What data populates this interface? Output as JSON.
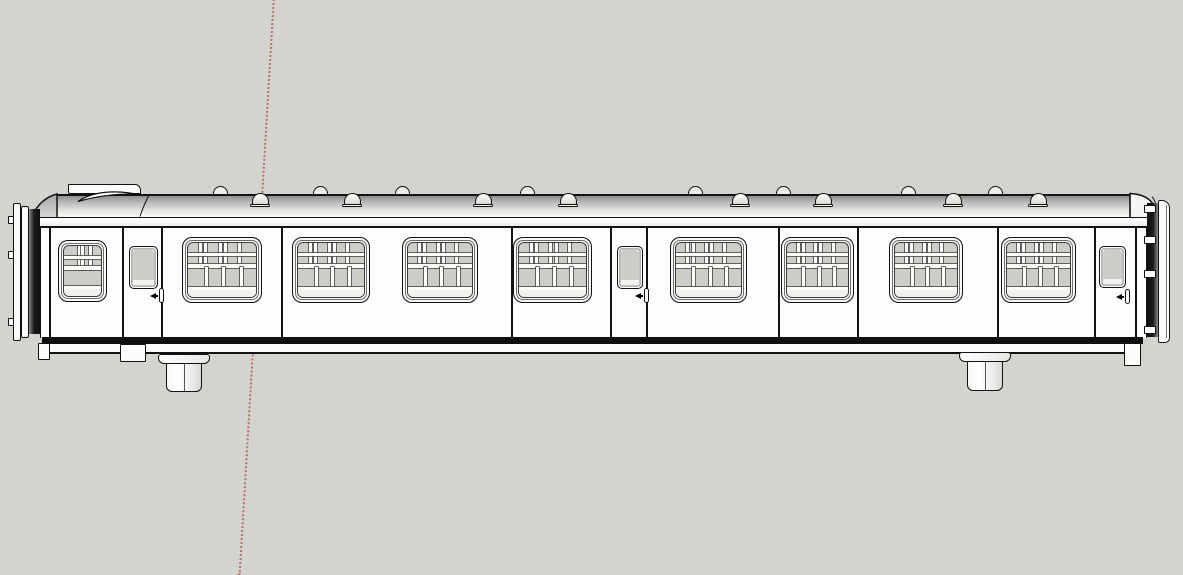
{
  "scene": {
    "app": "3d-modeler-viewport",
    "object": "railway-carriage-side-elevation",
    "canvas": {
      "w": 1183,
      "h": 569
    },
    "background": "#d4d4ce"
  },
  "colors": {
    "outline": "#121212",
    "outline_soft": "#444444",
    "body_white": "#fdfdfc",
    "frame_white": "#fbfbf9",
    "glass": "#cdcdc7",
    "glass_light": "#f1f1ee",
    "roof_grad_top": "#8f8f8f",
    "roof_grad_mid": "#e9e9e6",
    "roof_grad_bottom": "#fafaf8",
    "dark_end": "#1c1c1c",
    "axis_red": "#b05f5f"
  },
  "axis_line": {
    "x_top": 273,
    "y_top": -4,
    "length": 580,
    "angle_deg": 3.4,
    "dot": "2px dotted"
  },
  "carriage": {
    "roof": {
      "x": 56,
      "y": 194,
      "w": 1074,
      "h": 23
    },
    "roof_tab": {
      "x": 68,
      "y": 184,
      "w": 73,
      "h": 10
    },
    "cantrail": {
      "x": 31,
      "y": 217,
      "w": 1117,
      "h": 11
    },
    "body": {
      "x": 40,
      "y": 228,
      "w": 1107,
      "h": 110
    },
    "solebar": {
      "x": 42,
      "y": 337,
      "w": 1101,
      "h": 7
    },
    "underframe": {
      "x": 47,
      "y": 344,
      "w": 1092,
      "h": 10
    },
    "panel_lines_x": [
      49,
      281,
      511,
      778,
      857,
      997
    ],
    "window_y": 237,
    "window_h": 66,
    "windows_large": [
      {
        "x": 182,
        "w": 80
      },
      {
        "x": 292,
        "w": 78
      },
      {
        "x": 402,
        "w": 76
      },
      {
        "x": 513,
        "w": 79
      },
      {
        "x": 670,
        "w": 77
      },
      {
        "x": 781,
        "w": 73
      },
      {
        "x": 889,
        "w": 74
      },
      {
        "x": 1001,
        "w": 75
      }
    ],
    "window_detail": {
      "vent_mullions_rel": [
        0.16,
        0.24,
        0.45,
        0.53,
        0.73
      ],
      "rail1_y": 10,
      "rail2_y": 21,
      "rail3_y": 44,
      "partitions_rel": [
        0.25,
        0.5,
        0.76
      ],
      "partition_top": 24,
      "partition_h": 20,
      "clear_glass_from_y": 47
    },
    "window_small": {
      "x": 58,
      "y": 240,
      "w": 49,
      "h": 62,
      "vent_mullions_rel": [
        0.38,
        0.46,
        0.68
      ],
      "rail1_y": 10,
      "rail2_y": 20,
      "rail3_y": 40,
      "clear_glass_from_y": 43
    },
    "doors": [
      {
        "x": 122,
        "w": 41,
        "win": {
          "x": 129,
          "y": 246,
          "w": 29,
          "h": 43
        },
        "handle_x": 159,
        "handle_y": 288
      },
      {
        "x": 610,
        "w": 38,
        "win": {
          "x": 617,
          "y": 246,
          "w": 26,
          "h": 43
        },
        "handle_x": 644,
        "handle_y": 288
      },
      {
        "x": 1094,
        "w": 43,
        "win": {
          "x": 1099,
          "y": 246,
          "w": 27,
          "h": 42
        },
        "handle_x": 1125,
        "handle_y": 289
      }
    ],
    "roof_vents": {
      "far_cx": [
        220,
        320,
        402,
        527,
        695,
        783,
        908,
        995
      ],
      "near_cx": [
        260,
        352,
        483,
        568,
        740,
        823,
        953,
        1038
      ],
      "far_size": {
        "w": 15,
        "h": 9,
        "top": 186
      },
      "near_size": {
        "w": 17,
        "h": 12,
        "top": 193
      }
    },
    "cylinders": [
      {
        "cx": 184,
        "flange_y": 354,
        "flange_w": 52,
        "flange_h": 10,
        "body_w": 36,
        "body_h": 29
      },
      {
        "cx": 985,
        "flange_y": 352,
        "flange_w": 52,
        "flange_h": 10,
        "body_w": 36,
        "body_h": 30
      }
    ],
    "steps": [
      {
        "x": 38,
        "y": 343,
        "w": 12,
        "h": 17
      },
      {
        "x": 120,
        "y": 344,
        "w": 26,
        "h": 18
      },
      {
        "x": 1124,
        "y": 343,
        "w": 17,
        "h": 23
      }
    ],
    "left_end": {
      "plates": [
        {
          "x": 13,
          "y": 203,
          "w": 8,
          "h": 138
        },
        {
          "x": 21,
          "y": 206,
          "w": 8,
          "h": 132
        }
      ],
      "dark_strip": {
        "x": 29,
        "y": 209,
        "w": 11,
        "h": 125
      },
      "hinge_tabs": {
        "x": 8,
        "w": 6,
        "h": 8,
        "ys": [
          216,
          251,
          318
        ]
      }
    },
    "right_end": {
      "dark_strip": {
        "x": 1147,
        "y": 203,
        "w": 11,
        "h": 134
      },
      "hinge_blocks": {
        "x": 1144,
        "w": 12,
        "h": 8,
        "ys": [
          205,
          236,
          270,
          326
        ]
      },
      "plate": {
        "x": 1158,
        "y": 200,
        "w": 12,
        "h": 143
      }
    }
  }
}
